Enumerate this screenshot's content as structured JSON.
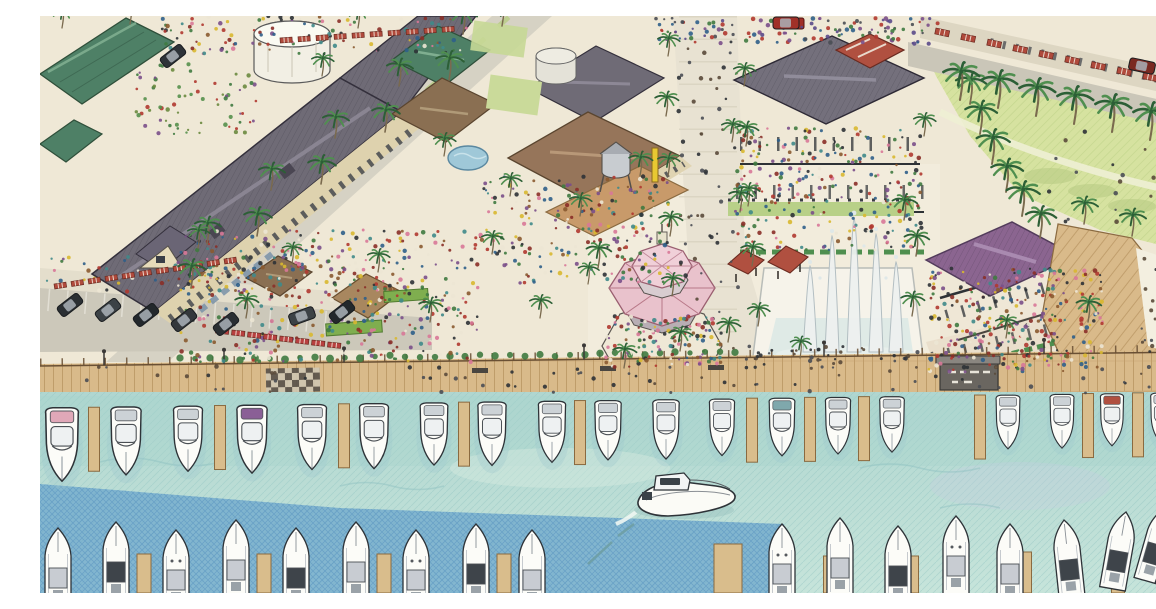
{
  "meta": {
    "type": "hand-drawn architectural rendering",
    "description": "Aerial colored-pencil rendering of a waterfront marina village: shop and restaurant blocks with slate, green, pink and purple roofs, palm-lined streets and promenade, a central fountain plaza, an octagonal dining pavilion, a great lawn with curving path, and a wooden boardwalk fronting a harbor full of docked white boats with one motor yacht cruising through the channel.",
    "stats": {
      "upper_docked_boats": 20,
      "lower_docked_boats": 18,
      "moving_boats": 1
    }
  },
  "palette": {
    "ground": "#efe8d6",
    "plaza": "#f2ecdc",
    "street": "#d6d2c4",
    "lawn": "#d6e2a0",
    "lawn_hatch": "#bcd086",
    "roof_slate": "#6f6b76",
    "roof_green": "#4e8066",
    "roof_brown": "#96755a",
    "roof_pink": "#e9c2cc",
    "roof_purple": "#8b6590",
    "roof_red": "#b05040",
    "boardwalk": "#d9ba8a",
    "dock": "#d9bd8c",
    "water_top": "#b0d6d0",
    "water_bottom": "#c6e4da",
    "water_deep": "#68a4cc",
    "boat_hull": "#fcfcf8",
    "boat_line": "#2e3338",
    "palm_dark": "#2c5f36",
    "palm_light": "#4f8f4f",
    "trunk": "#7a6a4e"
  },
  "crowd_palettes": {
    "warm": [
      "#b03830",
      "#8a2f28",
      "#3f7a40",
      "#2f5f8a",
      "#7a4f8a",
      "#d8b830",
      "#8a5a30",
      "#2e3236",
      "#d87898",
      "#3f8a8a",
      "#ece6d4"
    ],
    "roof": [
      "#7a4f8a",
      "#2f5f8a",
      "#b03830",
      "#4a4e54",
      "#3f7a40",
      "#5a4a8a"
    ],
    "dark": [
      "#2e3236",
      "#4a4e54",
      "#5a4a3a"
    ],
    "garden": [
      "#3f7a40",
      "#55904c",
      "#b03830",
      "#7a4f8a",
      "#6a8a3f"
    ]
  },
  "palms": [
    [
      151,
      272,
      1
    ],
    [
      167,
      228,
      0.95
    ],
    [
      217,
      220,
      1
    ],
    [
      231,
      174,
      0.95
    ],
    [
      281,
      168,
      1
    ],
    [
      295,
      122,
      0.95
    ],
    [
      345,
      116,
      1
    ],
    [
      359,
      70,
      0.95
    ],
    [
      409,
      64,
      1
    ],
    [
      423,
      18,
      0.95
    ],
    [
      462,
      10,
      0.9
    ],
    [
      628,
      40,
      0.8
    ],
    [
      626,
      100,
      0.85
    ],
    [
      628,
      160,
      0.8
    ],
    [
      630,
      220,
      0.85
    ],
    [
      632,
      280,
      0.8
    ],
    [
      640,
      335,
      0.85
    ],
    [
      704,
      70,
      0.8
    ],
    [
      706,
      130,
      0.85
    ],
    [
      708,
      190,
      0.8
    ],
    [
      712,
      250,
      0.85
    ],
    [
      718,
      310,
      0.8
    ],
    [
      158,
      232,
      0.8
    ],
    [
      206,
      302,
      0.85
    ],
    [
      252,
      248,
      0.75
    ],
    [
      338,
      256,
      0.8
    ],
    [
      390,
      306,
      0.85
    ],
    [
      452,
      238,
      0.8
    ],
    [
      500,
      302,
      0.8
    ],
    [
      548,
      268,
      0.75
    ],
    [
      470,
      180,
      0.8
    ],
    [
      540,
      200,
      0.8
    ],
    [
      600,
      160,
      0.85
    ],
    [
      558,
      252,
      0.9
    ],
    [
      584,
      352,
      0.85
    ],
    [
      688,
      326,
      0.85
    ],
    [
      700,
      196,
      0.85
    ],
    [
      864,
      204,
      0.9
    ],
    [
      872,
      300,
      0.85
    ],
    [
      692,
      126,
      0.8
    ],
    [
      884,
      120,
      0.8
    ],
    [
      876,
      240,
      0.9
    ],
    [
      1048,
      306,
      0.9
    ],
    [
      966,
      322,
      0.8
    ],
    [
      930,
      88,
      1.1
    ],
    [
      940,
      118,
      1.15
    ],
    [
      952,
      148,
      1.2
    ],
    [
      966,
      176,
      1.15
    ],
    [
      982,
      200,
      1.2
    ],
    [
      1000,
      222,
      1.1
    ],
    [
      920,
      84,
      1.3
    ],
    [
      958,
      92,
      1.3
    ],
    [
      996,
      100,
      1.3
    ],
    [
      1034,
      108,
      1.3
    ],
    [
      1072,
      116,
      1.3
    ],
    [
      1110,
      124,
      1.3
    ],
    [
      1146,
      132,
      1.25
    ],
    [
      1044,
      208,
      0.95
    ],
    [
      1092,
      220,
      0.95
    ],
    [
      1140,
      232,
      0.95
    ],
    [
      22,
      12,
      0.8
    ],
    [
      90,
      8,
      0.8
    ],
    [
      318,
      12,
      0.8
    ],
    [
      404,
      140,
      0.8
    ],
    [
      282,
      60,
      0.8
    ],
    [
      760,
      342,
      0.75
    ]
  ],
  "upper_boats": [
    [
      22,
      1.3,
      "#e0a8b8"
    ],
    [
      86,
      1.2,
      ""
    ],
    [
      148,
      1.15,
      ""
    ],
    [
      212,
      1.2,
      "#8a5f96"
    ],
    [
      272,
      1.15,
      ""
    ],
    [
      334,
      1.15,
      ""
    ],
    [
      394,
      1.1,
      ""
    ],
    [
      452,
      1.12,
      ""
    ],
    [
      512,
      1.08,
      ""
    ],
    [
      568,
      1.05,
      ""
    ],
    [
      626,
      1.05,
      ""
    ],
    [
      682,
      1,
      ""
    ],
    [
      742,
      1.02,
      "#7fa8ac"
    ],
    [
      798,
      1,
      ""
    ],
    [
      852,
      0.98,
      ""
    ],
    [
      968,
      0.95,
      ""
    ],
    [
      1022,
      0.95,
      ""
    ],
    [
      1072,
      0.92,
      "#b05040"
    ],
    [
      1122,
      0.9,
      ""
    ],
    [
      1152,
      0.9,
      ""
    ]
  ],
  "upper_docks": [
    54,
    180,
    304,
    424,
    540,
    712,
    770,
    824,
    940,
    1048,
    1098,
    1142
  ],
  "bottom_boats": [
    [
      18,
      512,
      0,
      "plain"
    ],
    [
      76,
      506,
      0,
      "dark"
    ],
    [
      136,
      514,
      0,
      "dots"
    ],
    [
      196,
      504,
      0,
      "plain"
    ],
    [
      256,
      512,
      0,
      "dark"
    ],
    [
      316,
      506,
      0,
      "plain"
    ],
    [
      376,
      514,
      0,
      "dots"
    ],
    [
      436,
      508,
      0,
      "dark"
    ],
    [
      492,
      514,
      0,
      "plain"
    ],
    [
      742,
      508,
      0,
      "dots"
    ],
    [
      800,
      502,
      0,
      "plain"
    ],
    [
      858,
      510,
      0,
      "dark"
    ],
    [
      916,
      500,
      0,
      "dots"
    ],
    [
      970,
      508,
      0,
      "plain"
    ],
    [
      1024,
      504,
      -6,
      "dark"
    ],
    [
      1086,
      496,
      10,
      "dark"
    ],
    [
      1128,
      490,
      16,
      "dark"
    ],
    [
      1154,
      498,
      20,
      "plain"
    ]
  ],
  "bottom_docks": [
    [
      104,
      14,
      538
    ],
    [
      224,
      14,
      538
    ],
    [
      344,
      14,
      538
    ],
    [
      464,
      14,
      538
    ],
    [
      688,
      28,
      528
    ],
    [
      790,
      13,
      540
    ],
    [
      872,
      13,
      540
    ],
    [
      985,
      13,
      536
    ],
    [
      1078,
      13,
      532
    ]
  ],
  "cars": [
    [
      30,
      289,
      -38,
      "#2a2f33"
    ],
    [
      68,
      294,
      -38,
      "#3c4246"
    ],
    [
      106,
      299,
      -38,
      "#23282c"
    ],
    [
      144,
      304,
      -38,
      "#34383c"
    ],
    [
      186,
      308,
      -38,
      "#2a2f33"
    ],
    [
      262,
      300,
      -20,
      "#3c4246"
    ],
    [
      302,
      296,
      -38,
      "#23282c"
    ],
    [
      133,
      40,
      -38,
      "#2e3338"
    ],
    [
      1102,
      50,
      12,
      "#7a2a22"
    ],
    [
      746,
      7,
      0,
      "#a03028"
    ]
  ],
  "crowds": [
    {
      "name": "market",
      "x": 138,
      "y": 214,
      "w": 300,
      "h": 132,
      "n": 420,
      "pal": "warm"
    },
    {
      "name": "market-east",
      "x": 440,
      "y": 160,
      "w": 190,
      "h": 108,
      "n": 220,
      "pal": "warm"
    },
    {
      "name": "terrace-north",
      "x": 694,
      "y": 112,
      "w": 188,
      "h": 122,
      "n": 280,
      "pal": "warm"
    },
    {
      "name": "purple-terraces",
      "x": 888,
      "y": 252,
      "w": 176,
      "h": 104,
      "n": 320,
      "pal": "warm"
    },
    {
      "name": "gazebo-diners",
      "x": 566,
      "y": 300,
      "w": 116,
      "h": 52,
      "n": 130,
      "pal": "warm"
    },
    {
      "name": "rooftop-garden",
      "x": 616,
      "y": 2,
      "w": 284,
      "h": 26,
      "n": 130,
      "pal": "roof"
    },
    {
      "name": "top-left-stalls",
      "x": 118,
      "y": 0,
      "w": 310,
      "h": 38,
      "n": 120,
      "pal": "warm"
    },
    {
      "name": "courtyard-garden",
      "x": 96,
      "y": 48,
      "w": 120,
      "h": 70,
      "n": 70,
      "pal": "garden"
    },
    {
      "name": "fountain-plaza-people",
      "x": 700,
      "y": 330,
      "w": 180,
      "h": 22,
      "n": 40,
      "pal": "dark"
    },
    {
      "name": "right-plaza-people",
      "x": 1098,
      "y": 240,
      "w": 58,
      "h": 100,
      "n": 44,
      "pal": "dark"
    },
    {
      "name": "boardwalk-people",
      "x": 4,
      "y": 350,
      "w": 1146,
      "h": 28,
      "n": 70,
      "pal": "dark"
    },
    {
      "name": "promenade-people",
      "x": 638,
      "y": 14,
      "w": 60,
      "h": 320,
      "n": 55,
      "pal": "dark"
    },
    {
      "name": "sidewalk-people",
      "x": 4,
      "y": 240,
      "w": 370,
      "h": 36,
      "n": 90,
      "pal": "warm"
    },
    {
      "name": "lawn-people",
      "x": 1008,
      "y": 112,
      "w": 142,
      "h": 96,
      "n": 16,
      "pal": "dark"
    }
  ],
  "awning_rows": [
    {
      "x": 14,
      "y": 268,
      "dx": 17,
      "dy": -2.5,
      "n": 11,
      "w": 12,
      "h": 5,
      "rot": -9,
      "color": "#b04a3c"
    },
    {
      "x": 896,
      "y": 12,
      "dx": 26,
      "dy": 5.6,
      "n": 10,
      "w": 14,
      "h": 6,
      "rot": 12,
      "color": "#b04a3c"
    },
    {
      "x": 176,
      "y": 312,
      "dx": 16,
      "dy": 2,
      "n": 8,
      "w": 13,
      "h": 5,
      "rot": 6,
      "color": "#b84040"
    },
    {
      "x": 240,
      "y": 22,
      "dx": 18,
      "dy": -1.2,
      "n": 10,
      "w": 12,
      "h": 5,
      "rot": -4,
      "color": "#b04a3c"
    }
  ],
  "lamps": [
    64,
    184,
    304,
    544,
    784,
    1004
  ],
  "shrubs": {
    "x0": 140,
    "x1": 706,
    "step": 15,
    "y": 345,
    "slope": -0.012
  }
}
